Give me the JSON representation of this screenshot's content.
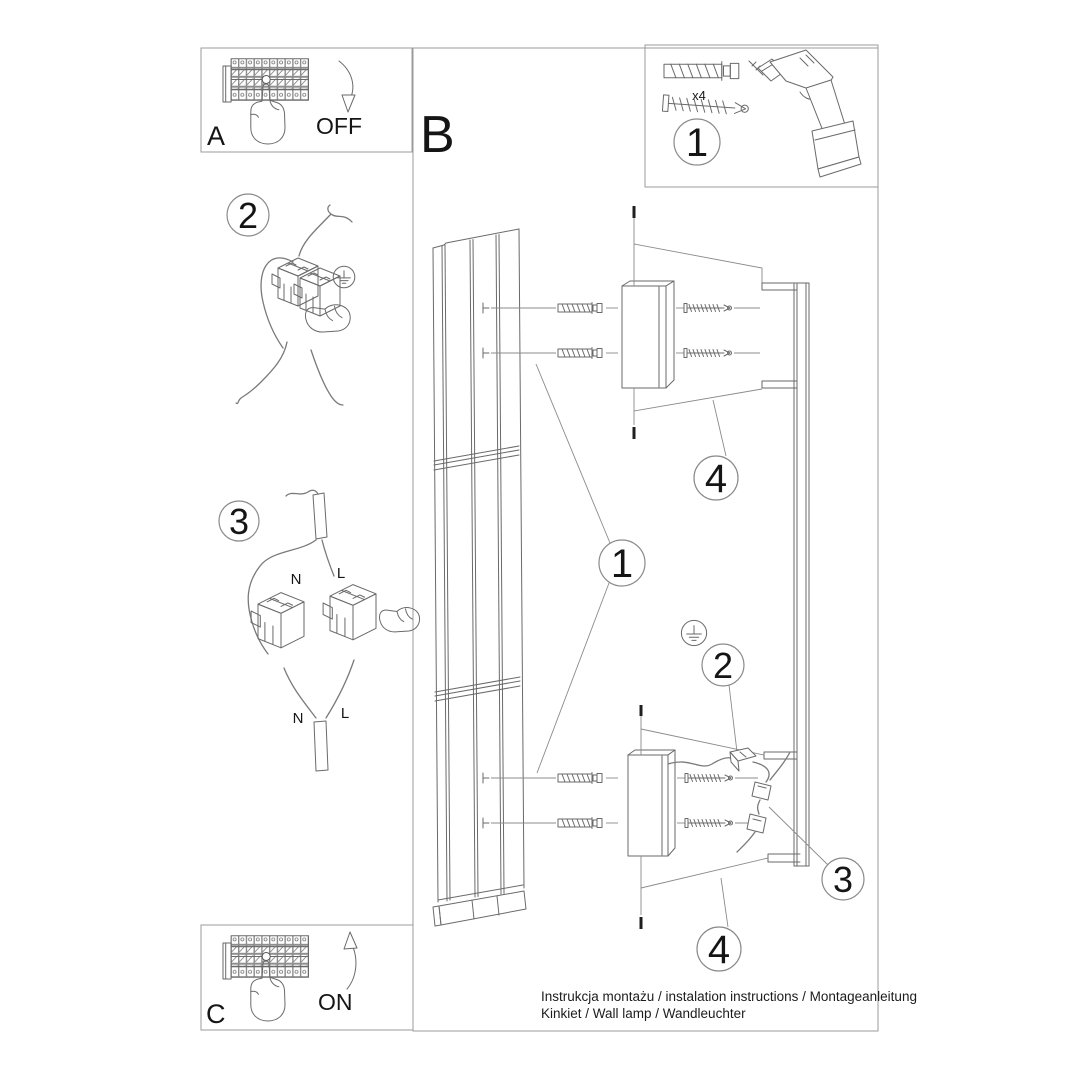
{
  "colors": {
    "background": "#ffffff",
    "line_art": "#6a6a6a",
    "frame": "#9b9b9b",
    "text": "#151515"
  },
  "panel_a": {
    "letter": "A",
    "state_label": "OFF"
  },
  "panel_b": {
    "letter": "B"
  },
  "panel_c": {
    "letter": "C",
    "state_label": "ON"
  },
  "parts": {
    "anchor_count": "x4"
  },
  "steps": {
    "one": "1",
    "two": "2",
    "three": "3",
    "four": "4"
  },
  "wire_labels": {
    "neutral": "N",
    "live": "L"
  },
  "footer": {
    "line1": "Instrukcja montażu / instalation instructions / Montageanleitung",
    "line2": "Kinkiet / Wall lamp / Wandleuchter"
  },
  "icons": {
    "breaker": "circuit-breaker-icon",
    "hand": "pointing-hand-icon",
    "arrow_off": "curved-arrow-down-icon",
    "arrow_on": "curved-arrow-up-icon",
    "drill": "power-drill-icon",
    "anchor": "wall-plug-icon",
    "screw": "screw-icon",
    "ground": "ground-symbol-icon",
    "connector": "terminal-connector-icon"
  }
}
